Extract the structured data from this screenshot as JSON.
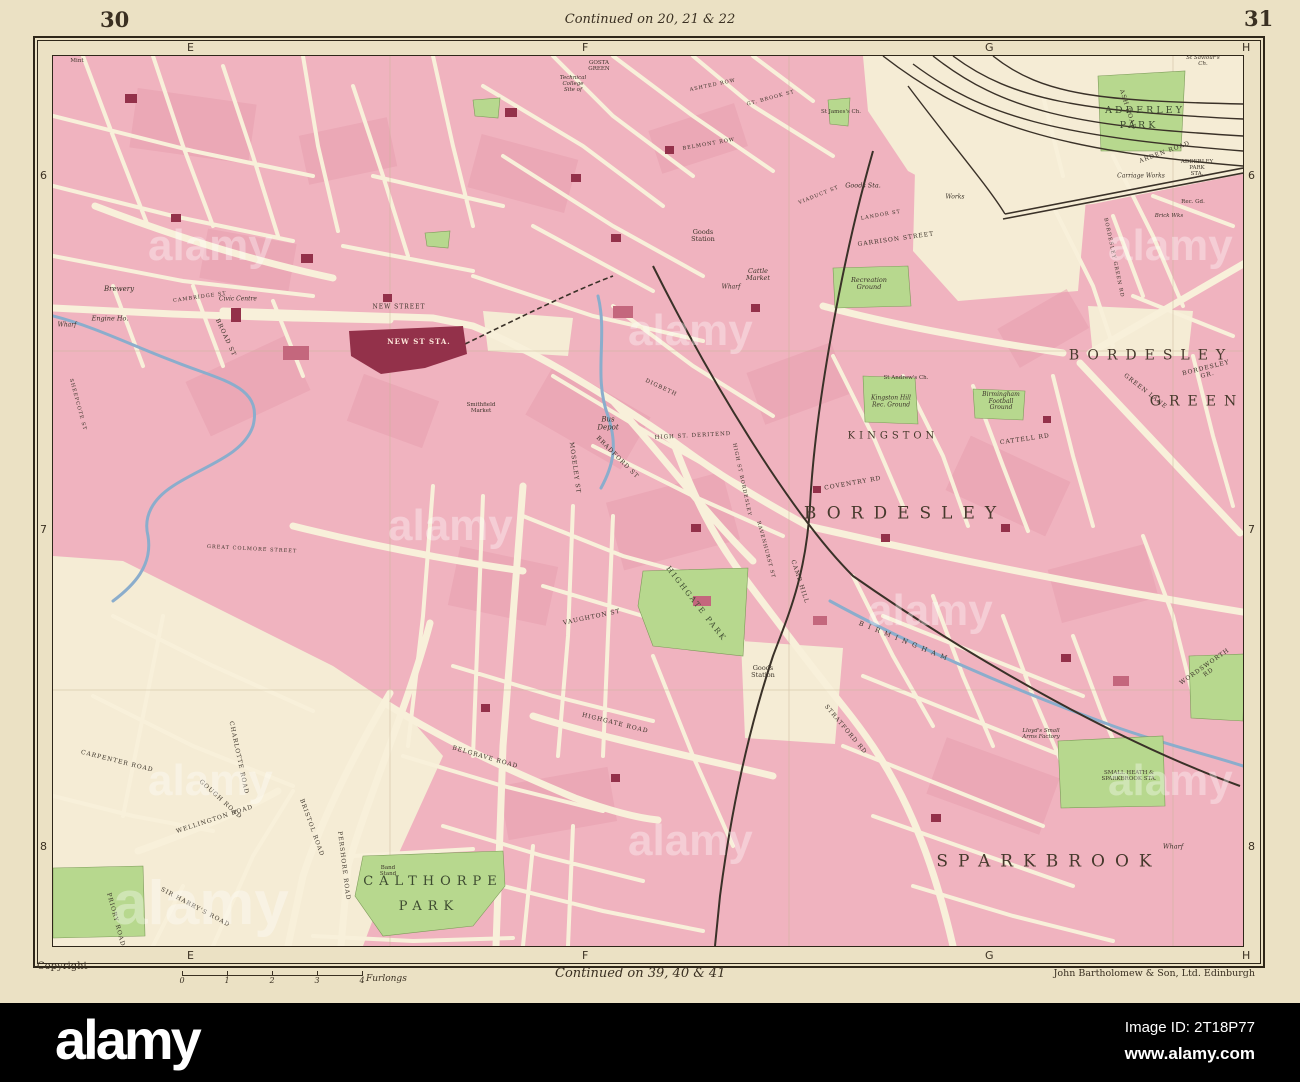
{
  "sheet": {
    "page_left": "30",
    "page_right": "31",
    "continued_top": "Continued on 20, 21 & 22",
    "continued_bottom": "Continued on 39, 40 & 41",
    "copyright": "Copyright",
    "publisher": "John Bartholomew & Son, Ltd. Edinburgh",
    "scale": {
      "ticks": [
        "0",
        "1",
        "2",
        "3",
        "4"
      ],
      "unit": "Furlongs"
    }
  },
  "grid": {
    "top": [
      {
        "t": "E",
        "x": 139
      },
      {
        "t": "F",
        "x": 534
      },
      {
        "t": "G",
        "x": 937
      },
      {
        "t": "H",
        "x": 1194
      }
    ],
    "bottom": [
      {
        "t": "E",
        "x": 139
      },
      {
        "t": "F",
        "x": 534
      },
      {
        "t": "G",
        "x": 937
      },
      {
        "t": "H",
        "x": 1194
      }
    ],
    "left": [
      {
        "t": "6",
        "y": 121
      },
      {
        "t": "7",
        "y": 475
      },
      {
        "t": "8",
        "y": 792
      }
    ],
    "right": [
      {
        "t": "6",
        "y": 121
      },
      {
        "t": "7",
        "y": 475
      },
      {
        "t": "8",
        "y": 792
      }
    ]
  },
  "palette": {
    "paper": "#ebe1c4",
    "map_bg": "#f5ecd5",
    "block_pink": "#f0b3bf",
    "block_dark": "#e79cac",
    "road_cream": "#f8f0da",
    "park_green": "#b7d88e",
    "water_blue": "#8badcc",
    "rail_black": "#3a3128",
    "building_red": "#93314a",
    "frame_ink": "#2e2619",
    "label_ink": "#3c342a",
    "bar_black": "#000000"
  },
  "watermarks": {
    "text": "alamy",
    "spots": [
      [
        95,
        165,
        44
      ],
      [
        575,
        250,
        44
      ],
      [
        1055,
        165,
        44
      ],
      [
        335,
        445,
        44
      ],
      [
        815,
        530,
        44
      ],
      [
        95,
        700,
        44
      ],
      [
        575,
        760,
        44
      ],
      [
        1055,
        700,
        44
      ],
      [
        60,
        812,
        62
      ]
    ]
  },
  "map": {
    "labels": [
      {
        "t": "BORDESLEY",
        "x": 852,
        "y": 458,
        "c": "d1"
      },
      {
        "t": "SPARKBROOK",
        "x": 996,
        "y": 806,
        "c": "d1"
      },
      {
        "t": "BORDESLEY",
        "x": 1098,
        "y": 300,
        "c": "d2"
      },
      {
        "t": "GREEN",
        "x": 1144,
        "y": 346,
        "c": "d2"
      },
      {
        "t": "KINGSTON",
        "x": 840,
        "y": 380,
        "c": "d2",
        "s": 10,
        "ls": 4
      },
      {
        "t": "GOSTA\nGREEN",
        "x": 546,
        "y": 10,
        "c": "tn"
      },
      {
        "t": "CALTHORPE",
        "x": 380,
        "y": 826,
        "c": "p"
      },
      {
        "t": "PARK",
        "x": 376,
        "y": 851,
        "c": "p"
      },
      {
        "t": "ADDERLEY",
        "x": 1092,
        "y": 55,
        "c": "p2"
      },
      {
        "t": "PARK",
        "x": 1086,
        "y": 70,
        "c": "p2"
      },
      {
        "t": "HIGHGATE PARK",
        "x": 643,
        "y": 548,
        "r": 52,
        "c": "pl"
      },
      {
        "t": "NEW ST STA.",
        "x": 366,
        "y": 286,
        "c": "st"
      },
      {
        "t": "NEW STREET",
        "x": 346,
        "y": 252,
        "c": "rd"
      },
      {
        "t": "Bus\nDepot",
        "x": 555,
        "y": 368,
        "c": "it",
        "s": 7
      },
      {
        "t": "HIGH ST. DERITEND",
        "x": 640,
        "y": 380,
        "r": -3,
        "c": "rd",
        "s": 5.5
      },
      {
        "t": "Goods\nStation",
        "x": 650,
        "y": 180,
        "c": "sm"
      },
      {
        "t": "Goods Sta.",
        "x": 810,
        "y": 130,
        "c": "it"
      },
      {
        "t": "Works",
        "x": 902,
        "y": 142,
        "c": "it",
        "s": 6
      },
      {
        "t": "Cattle\nMarket",
        "x": 705,
        "y": 219,
        "c": "it"
      },
      {
        "t": "Wharf",
        "x": 678,
        "y": 232,
        "c": "it",
        "s": 6
      },
      {
        "t": "Recreation\nGround",
        "x": 816,
        "y": 228,
        "c": "it"
      },
      {
        "t": "GARRISON STREET",
        "x": 843,
        "y": 184,
        "r": -8,
        "c": "rd"
      },
      {
        "t": "LANDOR ST",
        "x": 828,
        "y": 160,
        "r": -10,
        "c": "rd",
        "s": 5
      },
      {
        "t": "St Andrew's Ch.",
        "x": 853,
        "y": 322,
        "c": "tn"
      },
      {
        "t": "Kingston Hill\nRec. Ground",
        "x": 838,
        "y": 346,
        "c": "it",
        "s": 6
      },
      {
        "t": "Birmingham\nFootball\nGround",
        "x": 948,
        "y": 346,
        "c": "it",
        "s": 6
      },
      {
        "t": "Brewery",
        "x": 66,
        "y": 234,
        "c": "it",
        "s": 7
      },
      {
        "t": "Engine Ho.",
        "x": 57,
        "y": 263,
        "c": "it"
      },
      {
        "t": "Wharf",
        "x": 14,
        "y": 270,
        "c": "it",
        "s": 6
      },
      {
        "t": "Civic Centre",
        "x": 185,
        "y": 244,
        "c": "it",
        "s": 6
      },
      {
        "t": "Band\nStand",
        "x": 335,
        "y": 815,
        "c": "tn"
      },
      {
        "t": "Wharf",
        "x": 1120,
        "y": 791,
        "c": "it"
      },
      {
        "t": "ADDERLEY PARK\nSTA.",
        "x": 1144,
        "y": 112,
        "c": "tn"
      },
      {
        "t": "Carriage Works",
        "x": 1088,
        "y": 121,
        "c": "it",
        "s": 6
      },
      {
        "t": "Brick Wks",
        "x": 1116,
        "y": 160,
        "c": "it",
        "s": 5.5
      },
      {
        "t": "Rec. Gd.",
        "x": 1140,
        "y": 146,
        "c": "tn"
      },
      {
        "t": "St Saviour's Ch.",
        "x": 1150,
        "y": 5,
        "c": "it",
        "s": 5.5
      },
      {
        "t": "Lloyd's Small\nArms Factory",
        "x": 988,
        "y": 678,
        "c": "it",
        "s": 5.5
      },
      {
        "t": "SMALL HEATH &\nSPARKBROOK STA.",
        "x": 1076,
        "y": 720,
        "c": "tn"
      },
      {
        "t": "Goods\nStation",
        "x": 710,
        "y": 616,
        "c": "sm"
      },
      {
        "t": "Technical\nCollege\nSite of",
        "x": 520,
        "y": 28,
        "c": "it",
        "s": 5.5
      },
      {
        "t": "St James's Ch.",
        "x": 788,
        "y": 56,
        "c": "tn"
      },
      {
        "t": "Smithfield\nMarket",
        "x": 428,
        "y": 352,
        "c": "tn"
      },
      {
        "t": "Mint",
        "x": 24,
        "y": 5,
        "c": "tn"
      },
      {
        "t": "COVENTRY RD",
        "x": 800,
        "y": 428,
        "r": -10,
        "c": "rd"
      },
      {
        "t": "CAMP HILL",
        "x": 746,
        "y": 526,
        "r": 72,
        "c": "rd"
      },
      {
        "t": "STRATFORD RD",
        "x": 792,
        "y": 674,
        "r": 50,
        "c": "rd"
      },
      {
        "t": "HIGHGATE ROAD",
        "x": 562,
        "y": 668,
        "r": 14,
        "c": "rd"
      },
      {
        "t": "BELGRAVE ROAD",
        "x": 432,
        "y": 702,
        "r": 16,
        "c": "rd"
      },
      {
        "t": "PERSHORE ROAD",
        "x": 290,
        "y": 810,
        "r": 83,
        "c": "rd"
      },
      {
        "t": "BRISTOL ROAD",
        "x": 258,
        "y": 772,
        "r": 70,
        "c": "rd"
      },
      {
        "t": "WELLINGTON ROAD",
        "x": 162,
        "y": 764,
        "r": -18,
        "c": "rd"
      },
      {
        "t": "SIR HARRY'S ROAD",
        "x": 142,
        "y": 852,
        "r": 28,
        "c": "rd"
      },
      {
        "t": "GOUGH ROAD",
        "x": 167,
        "y": 744,
        "r": 42,
        "c": "rd"
      },
      {
        "t": "CARPENTER ROAD",
        "x": 64,
        "y": 706,
        "r": 14,
        "c": "rd"
      },
      {
        "t": "PRIORY ROAD",
        "x": 62,
        "y": 864,
        "r": 75,
        "c": "rd"
      },
      {
        "t": "CHARLOTTE ROAD",
        "x": 185,
        "y": 702,
        "r": 78,
        "c": "rd"
      },
      {
        "t": "MOSELEY ST",
        "x": 521,
        "y": 412,
        "r": 82,
        "c": "rd"
      },
      {
        "t": "BRADFORD ST",
        "x": 564,
        "y": 402,
        "r": 45,
        "c": "rd"
      },
      {
        "t": "HIGH ST BORDESLEY",
        "x": 688,
        "y": 424,
        "r": 78,
        "c": "rd",
        "s": 5
      },
      {
        "t": "GREEN LANE",
        "x": 1092,
        "y": 336,
        "r": 38,
        "c": "rd"
      },
      {
        "t": "BORDESLEY GR.",
        "x": 1154,
        "y": 316,
        "r": -14,
        "c": "rd"
      },
      {
        "t": "BORDESLEY GREEN RD",
        "x": 1060,
        "y": 202,
        "r": 78,
        "c": "rd",
        "s": 5
      },
      {
        "t": "WORDSWORTH RD",
        "x": 1154,
        "y": 614,
        "r": -35,
        "c": "rd"
      },
      {
        "t": "BIRMINGHAM",
        "x": 852,
        "y": 586,
        "r": 22,
        "c": "rd",
        "s": 6.5,
        "ls": 5
      },
      {
        "t": "ASH ROAD",
        "x": 1074,
        "y": 54,
        "r": 72,
        "c": "rd"
      },
      {
        "t": "ARDEN ROAD",
        "x": 1112,
        "y": 97,
        "r": -20,
        "c": "rd"
      },
      {
        "t": "BROAD ST",
        "x": 172,
        "y": 282,
        "r": 65,
        "c": "rd"
      },
      {
        "t": "CAMBRIDGE ST",
        "x": 147,
        "y": 242,
        "r": -8,
        "c": "rd",
        "s": 5
      },
      {
        "t": "SHEEPCOTE ST",
        "x": 24,
        "y": 349,
        "r": 75,
        "c": "rd",
        "s": 5
      },
      {
        "t": "GREAT COLMORE STREET",
        "x": 199,
        "y": 494,
        "r": 3,
        "c": "rd",
        "s": 5
      },
      {
        "t": "VAUGHTON ST",
        "x": 539,
        "y": 562,
        "r": -12,
        "c": "rd"
      },
      {
        "t": "RAVENHURST ST",
        "x": 712,
        "y": 494,
        "r": 75,
        "c": "rd",
        "s": 5
      },
      {
        "t": "CATTELL RD",
        "x": 972,
        "y": 384,
        "r": -8,
        "c": "rd"
      },
      {
        "t": "ASHTED ROW",
        "x": 660,
        "y": 30,
        "r": -12,
        "c": "rd",
        "s": 5
      },
      {
        "t": "GT. BROOK ST",
        "x": 718,
        "y": 43,
        "r": -15,
        "c": "rd",
        "s": 5
      },
      {
        "t": "BELMONT ROW",
        "x": 656,
        "y": 89,
        "r": -10,
        "c": "rd",
        "s": 5
      },
      {
        "t": "VIADUCT ST",
        "x": 766,
        "y": 140,
        "r": -22,
        "c": "rd",
        "s": 5
      },
      {
        "t": "DIGBETH",
        "x": 608,
        "y": 332,
        "r": 25,
        "c": "rd",
        "s": 5.5
      }
    ]
  },
  "alamy_bar": {
    "logo": "alamy",
    "image_id": "Image ID: 2T18P77",
    "url": "www.alamy.com"
  }
}
